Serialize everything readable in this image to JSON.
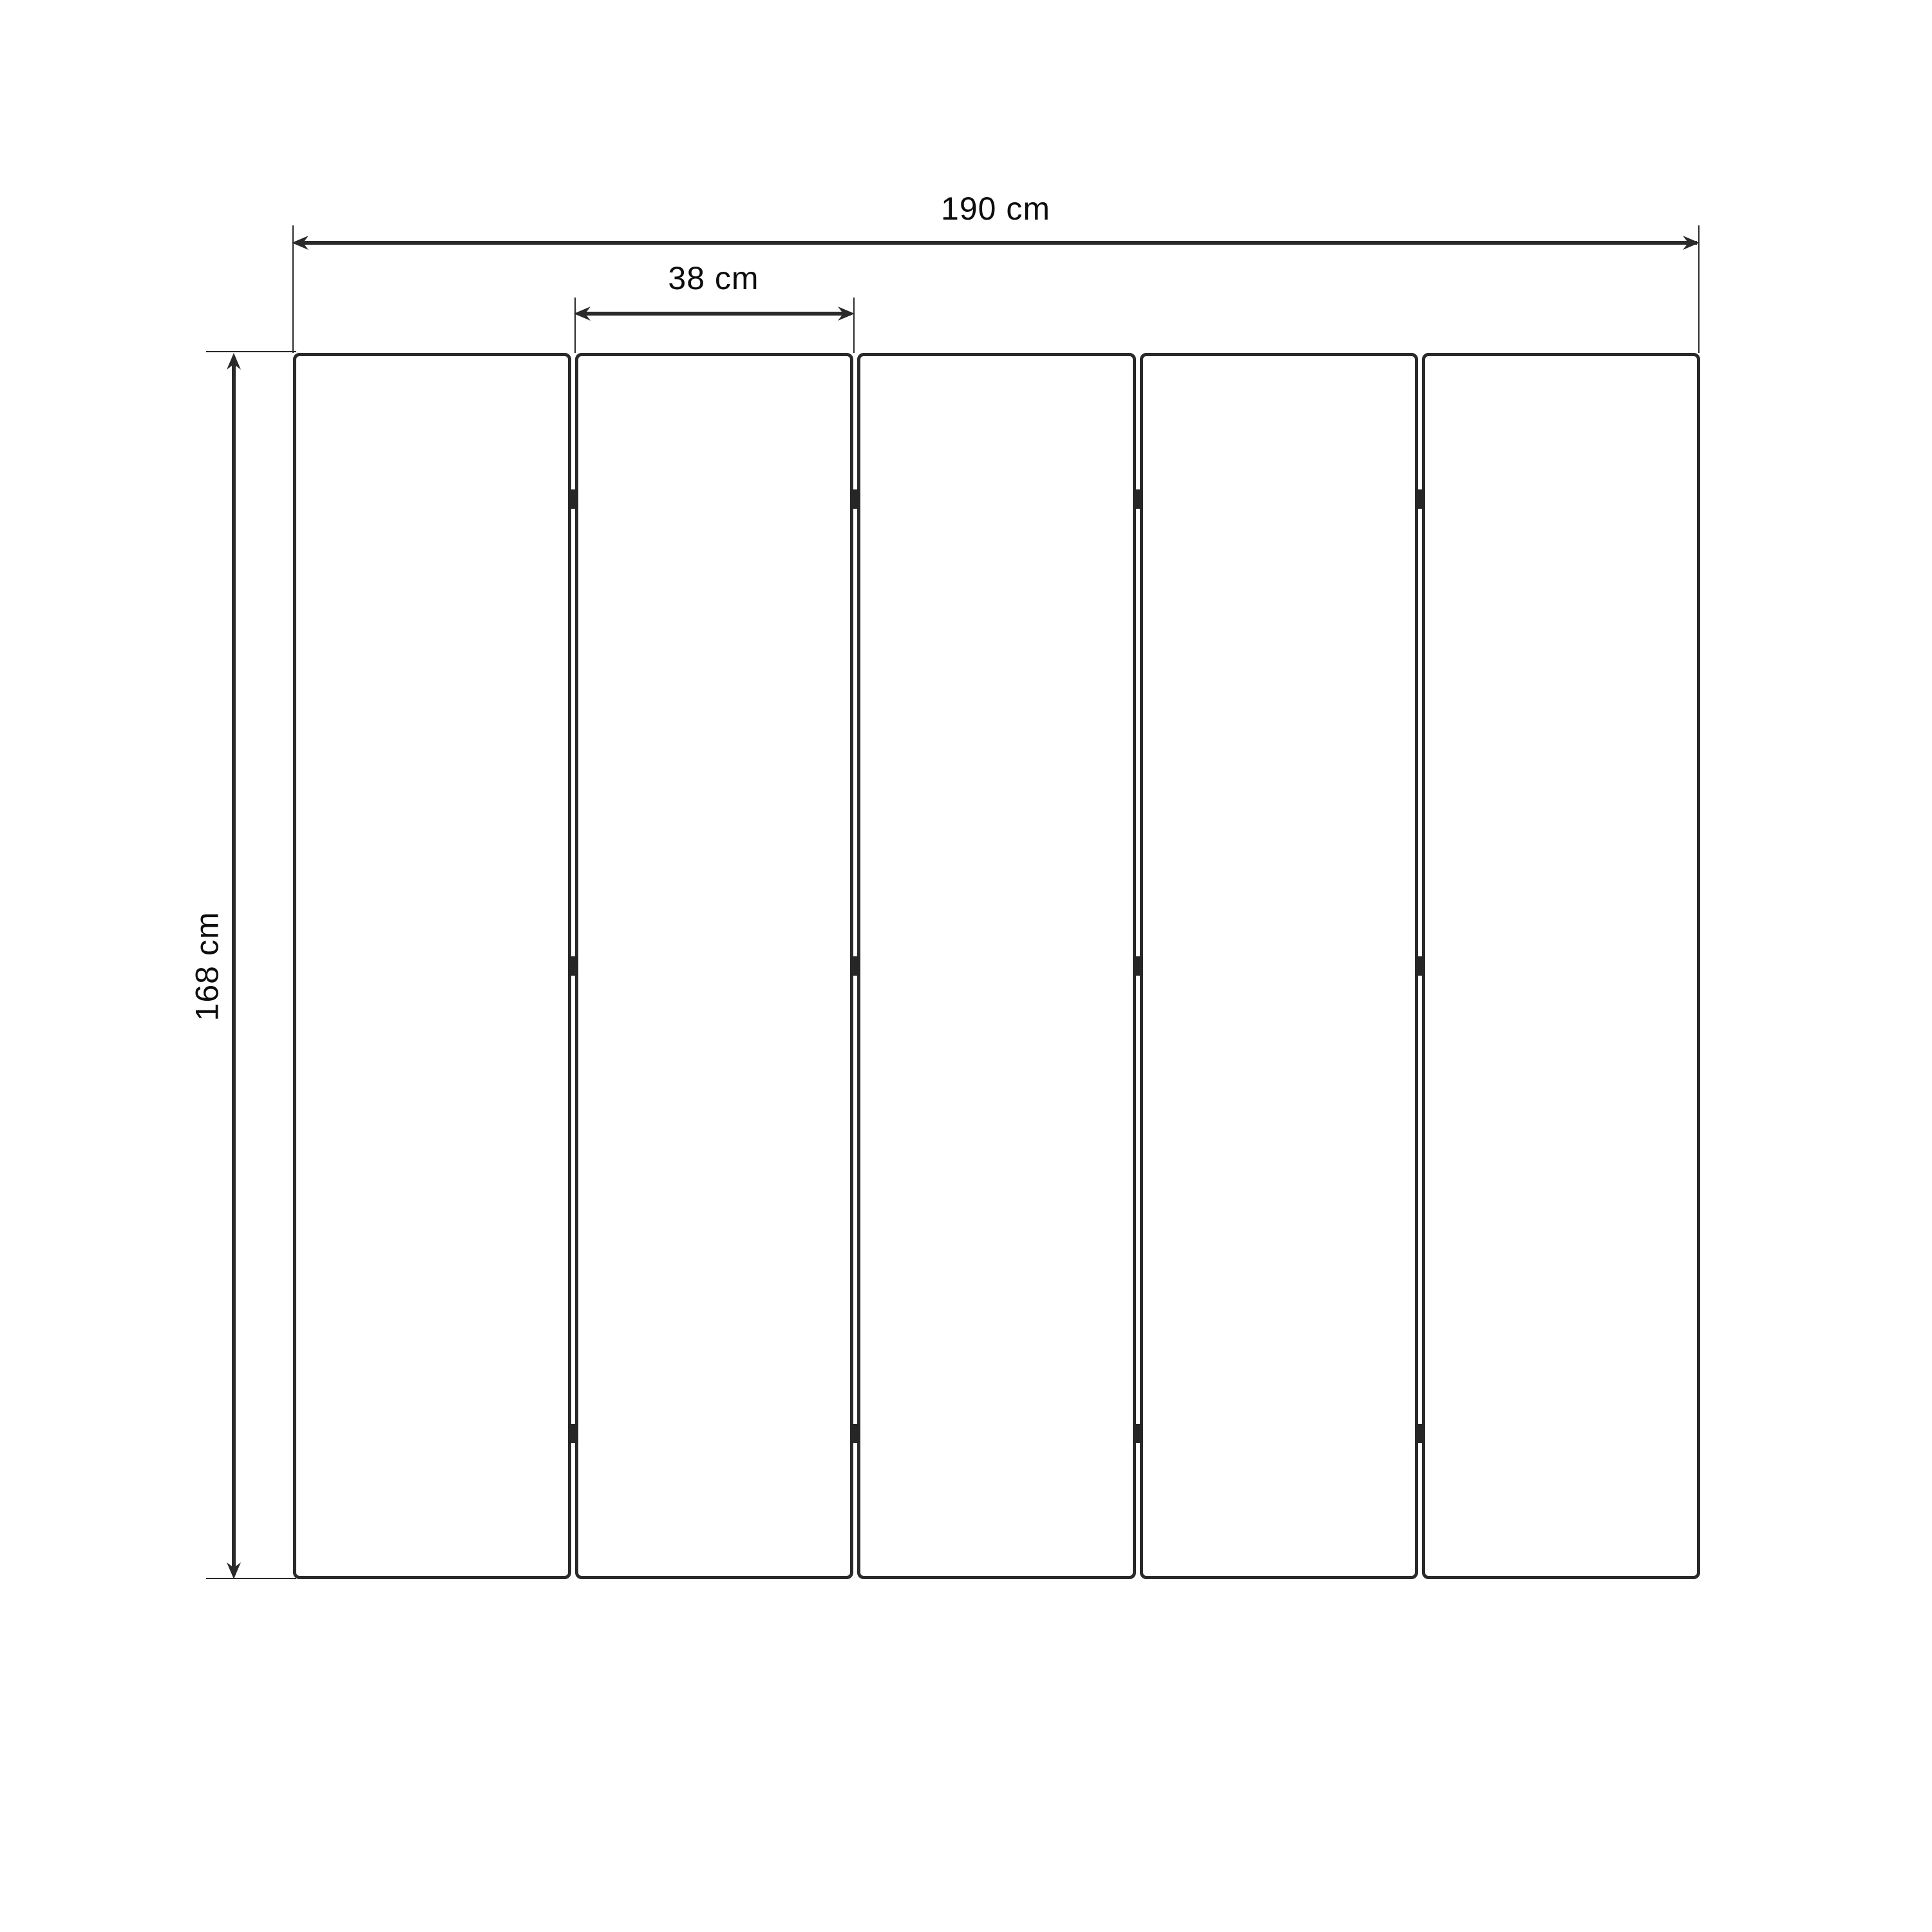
{
  "diagram": {
    "type": "folding-screen-dimension-drawing",
    "panel_count": 5,
    "hinge_rows": 3,
    "dimensions": {
      "total_width": {
        "label": "190 cm",
        "value": 190,
        "unit": "cm"
      },
      "panel_width": {
        "label": "38 cm",
        "value": 38,
        "unit": "cm"
      },
      "height": {
        "label": "168 cm",
        "value": 168,
        "unit": "cm"
      }
    },
    "colors": {
      "background": "#ffffff",
      "stroke": "#2a2a2a",
      "text": "#0d0d0d"
    }
  }
}
